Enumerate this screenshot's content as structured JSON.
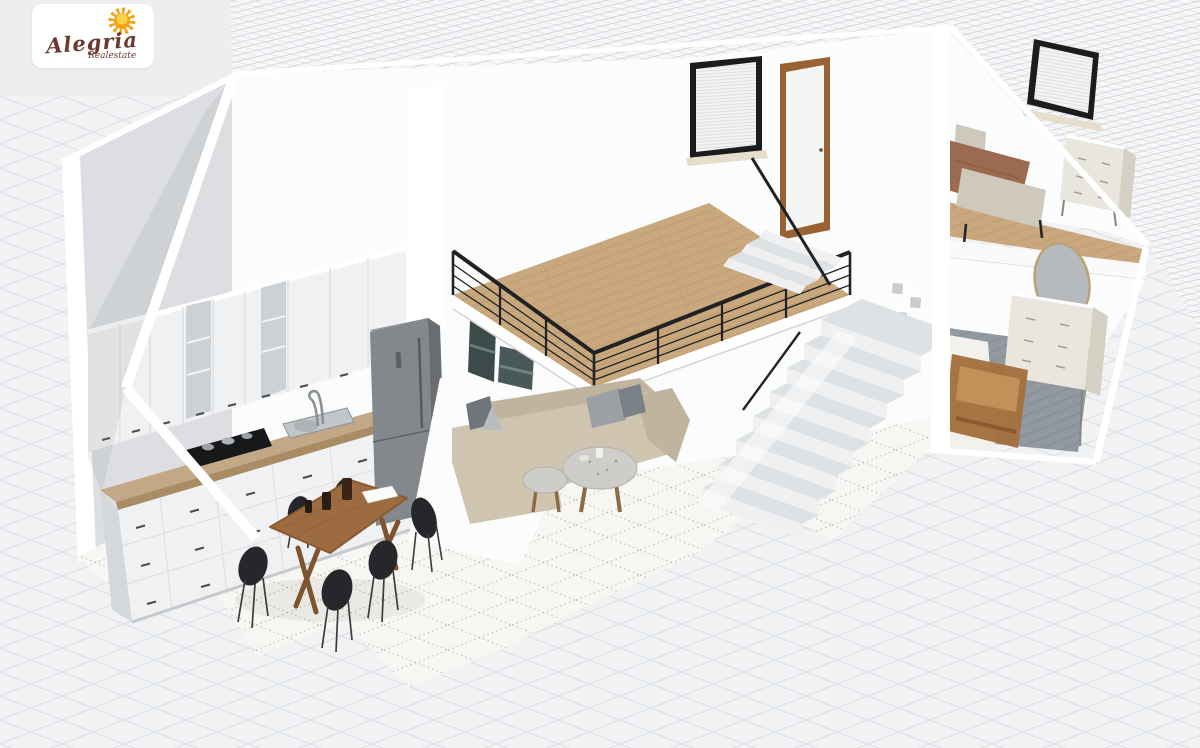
{
  "logo": {
    "brand": "Alegria",
    "tagline": "Realestate"
  },
  "scene": {
    "description": "3D cutaway floor plan render of a two-level loft apartment, viewed isometrically from the upper left",
    "rooms": [
      {
        "name": "kitchen",
        "furniture": [
          "upper cabinets with glass doors",
          "base cabinets with drawers",
          "wooden countertop",
          "gas cooktop with pots",
          "sink with faucet",
          "refrigerator"
        ]
      },
      {
        "name": "dining-area",
        "furniture": [
          "wooden dining table",
          "six black chairs",
          "dark vases",
          "paper sheet"
        ]
      },
      {
        "name": "living-room",
        "furniture": [
          "beige sectional sofa",
          "gray pillows",
          "two round coffee tables",
          "two dark wall-art prints",
          "small pyramid decor"
        ]
      },
      {
        "name": "mezzanine",
        "furniture": [
          "oak plank floor",
          "black metal railing"
        ]
      },
      {
        "name": "staircase",
        "furniture": [
          "stone steps",
          "landing",
          "black handrail",
          "glass balustrade"
        ]
      },
      {
        "name": "upper-hallway",
        "furniture": [
          "window with blinds",
          "wooden door",
          "gallery picture frames"
        ]
      },
      {
        "name": "bedroom-upper",
        "furniture": [
          "double bed with brown duvet",
          "upholstered footboard",
          "window with blinds",
          "cream dresser"
        ]
      },
      {
        "name": "room-lower",
        "furniture": [
          "oval mirror",
          "cream dresser",
          "wooden bench headboard",
          "gray rug",
          "white bed"
        ]
      }
    ]
  },
  "palette": {
    "bg": "#eceef0",
    "hatchLine": "#c7cbd0",
    "hatchBg": "#f6f7f8",
    "tileLine": "#d9dde2",
    "tileBg": "#f1f2f4",
    "intTileBg": "#f7f6f2",
    "intTileDot": "#b9b2a6",
    "wallWhite": "#fbfcfc",
    "wallGray": "#dcdee1",
    "cutWhite": "#ffffff",
    "wood": "#c9a87d",
    "woodLine": "#ad8c60",
    "counter": "#c2a886",
    "counterEdge": "#a98c64",
    "cabinet": "#f0f1f2",
    "cabinetShade": "#d5d8db",
    "glass": "#ccd1d5",
    "handle": "#4a4c4e",
    "fridge": "#84878b",
    "fridgeSide": "#6a6d71",
    "fridgeTop": "#94979b",
    "railing": "#202224",
    "sofa": "#cfc4b0",
    "sofaShade": "#c0b49e",
    "pillow": "#9aa0a4",
    "pillowDark": "#6f767b",
    "tableWood": "#9c6b3f",
    "tableWoodDark": "#7d5430",
    "chair": "#26272a",
    "stepTop": "#dfe2e5",
    "stepFace": "#eef0f2",
    "doorWood": "#9a6233",
    "doorPanel": "#f4f5f5",
    "frameBlack": "#1b1c1e",
    "blind": "#f2f3f3",
    "blindLine": "#d8dadc",
    "sill": "#e6decb",
    "bedding": "#9c6a4e",
    "upholstery": "#cfc9bc",
    "dresser": "#e9e6dd",
    "dresserShade": "#d4d0c3",
    "mirror": "#b7babd",
    "mirrorFrame": "#bba276",
    "rug": "#9299a0",
    "rugDark": "#7d858c",
    "benchWood": "#a46f3e",
    "art1": "#3c4a49",
    "art2": "#49595a",
    "terrazzo": "#cfcdc9",
    "logoText": "#6b3a2e",
    "sunOuter": "#f2a315",
    "sunInner": "#fcd24a"
  }
}
